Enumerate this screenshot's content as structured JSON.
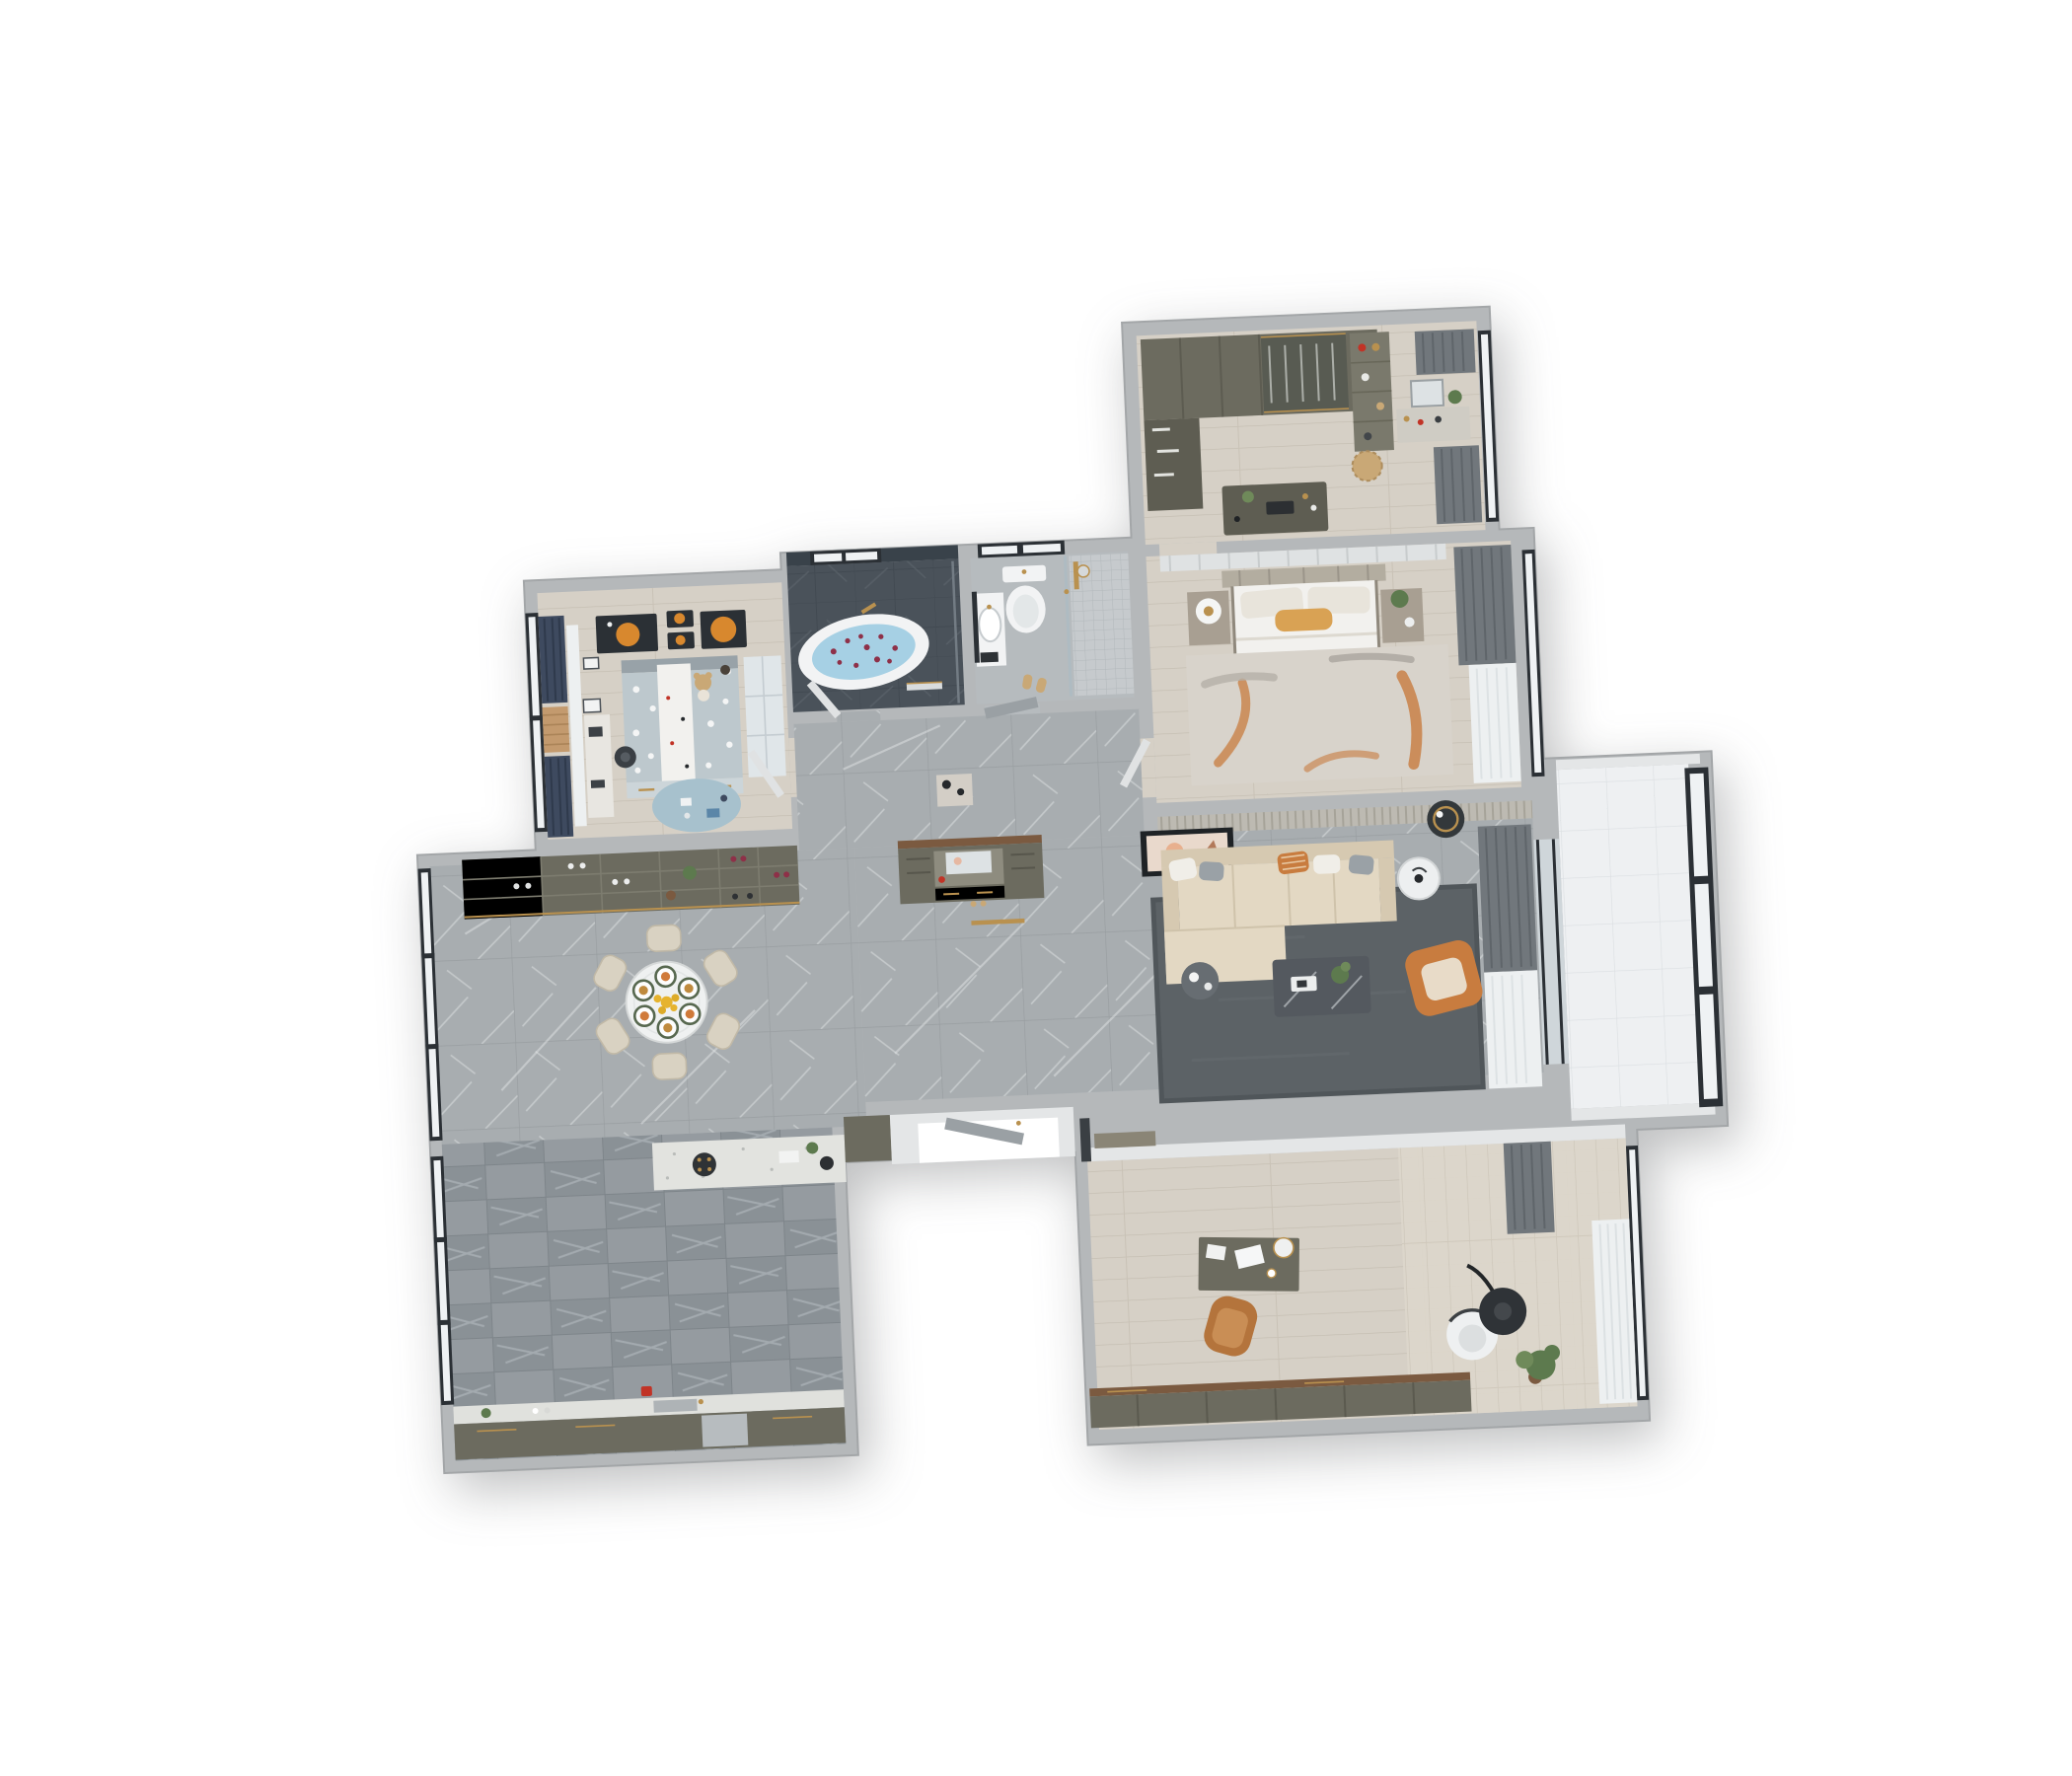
{
  "scene": {
    "type": "3d-rendered-apartment-floor-plan",
    "view": "top-down dollhouse cutaway",
    "background": "#ffffff",
    "visible_text": "none"
  },
  "palette": {
    "wall": "#b5b8ba",
    "wallEdge": "#a3a6a8",
    "wallWhite": "#e4e6e7",
    "floorMarble": "#a8adb0",
    "floorWood": "#d6d0c6",
    "floorWoodStudy": "#dad4c9",
    "floorKitchen": "#93999d",
    "floorBalcony": "#eef0f2",
    "floorBath": "#b6bbbe",
    "floorEntry": "#c9ccce",
    "slate": "#4a525a",
    "slateWall": "#39424a",
    "mosaic": "#c6cacd",
    "olive": "#6c6b5f",
    "oliveDark": "#5e5d52",
    "brownTop": "#7b5a40",
    "sofa": "#e3d8c3",
    "sofaShade": "#d6c9b1",
    "cushionWhite": "#f0eee8",
    "cushionGray": "#9aa1a6",
    "orange": "#c87c3f",
    "orangePillow": "#d9a254",
    "rugLiving": "#5c6266",
    "rugBedroom": "#d8d3cb",
    "rugKids": "#a7c1cd",
    "navy": "#3e4a5f",
    "curtain": "#71777c",
    "sheer": "#edf0f1",
    "frame": "#2b3035",
    "glass": "#eff2f4",
    "gold": "#b9914f",
    "fixture": "#f2f3f4",
    "water": "#a6d0e4",
    "petal": "#8e3048",
    "green": "#5d7a4e",
    "greenLight": "#6f8a5a",
    "tan": "#c9a876",
    "chairTan": "#b4743c",
    "black": "#26292c",
    "bedding": "#f2f1ee",
    "blanket": "#ccc5bb",
    "kidsBed": "#bdc8cd",
    "headboard": "#b3ada0",
    "nightstand": "#a89f92",
    "tableDark": "#54595f",
    "artPeach": "#e9d9cc",
    "artOrange": "#d8882e",
    "red": "#c13326",
    "doorGray": "#9aa0a4",
    "doorLight": "#e0e2e3",
    "chairDining": "#d9d2c2",
    "grille": "#bdbab2",
    "cabinetNiche": "#8e8c7f",
    "mirror": "#dde2e4"
  },
  "rooms": [
    {
      "id": "walk-in-closet",
      "label": "Walk-in closet / dressing room",
      "floor": "light wood",
      "furniture": [
        "wardrobe-hanging-clothes",
        "glass-front-wardrobe",
        "shelf-unit-with-bags",
        "vanity-with-mirror",
        "plants",
        "rattan-basket",
        "accessory-island",
        "gray-curtains",
        "window"
      ]
    },
    {
      "id": "master-bedroom",
      "label": "Master bedroom",
      "floor": "light wood",
      "furniture": [
        "double-bed",
        "slatted-headboard",
        "pillows",
        "orange-lumbar-pillow",
        "white-duvet",
        "foot-blanket",
        "nightstand-left",
        "round-table-lamp",
        "nightstand-right",
        "plant",
        "rug-orange-accents",
        "layered-curtains",
        "window",
        "door"
      ]
    },
    {
      "id": "bathroom-tub",
      "label": "Bathroom with freestanding tub",
      "floor": "dark slate",
      "furniture": [
        "oval-bathtub",
        "water-with-rose-petals",
        "gold-faucet",
        "towel-rail",
        "window",
        "door"
      ]
    },
    {
      "id": "bathroom-shower",
      "label": "Bathroom with shower",
      "floor": "light marble + mosaic",
      "furniture": [
        "wall-hung-toilet",
        "vanity-basin",
        "wall-mirror",
        "glass-shower-enclosure",
        "gold-shower-set",
        "slippers",
        "window",
        "door"
      ]
    },
    {
      "id": "kids-bedroom",
      "label": "Kids bedroom",
      "floor": "light wood",
      "furniture": [
        "single-bed-polka-dot-bedding",
        "white-blanket-runner",
        "teddy-bear",
        "toy-deer",
        "under-bed-drawers",
        "wardrobe",
        "study-desk",
        "desk-chair",
        "round-play-rug",
        "toys",
        "planet-artworks-x4",
        "navy-curtains",
        "sheer-curtain",
        "window",
        "door"
      ]
    },
    {
      "id": "dining-area",
      "label": "Dining area",
      "floor": "gray marble",
      "furniture": [
        "round-dining-table",
        "dining-chairs-x6",
        "place-settings-x6",
        "yellow-flower-centerpiece",
        "wine-display-cabinet",
        "glass-display-cabinet",
        "window-wall"
      ]
    },
    {
      "id": "kitchen",
      "label": "Kitchen",
      "floor": "dark patterned tile",
      "furniture": [
        "island-counter-with-hob",
        "plant-and-bowl",
        "base-cabinet-run",
        "countertop-with-sink",
        "dishwasher",
        "red-kettle",
        "tall-cabinet",
        "window-wall"
      ]
    },
    {
      "id": "living-room",
      "label": "Living room",
      "floor": "gray marble",
      "furniture": [
        "l-shaped-sectional-sofa",
        "throw-pillows",
        "striped-orange-pillow",
        "marble-coffee-table",
        "plant",
        "tray",
        "round-side-table-white",
        "round-side-table-dark",
        "orange-armchair",
        "dark-gray-rug",
        "wall-art",
        "black-ceiling-light",
        "curtains",
        "entry-shoe-cabinet-with-mirror-niche",
        "console-table",
        "gold-floor-strips",
        "ceiling-grille"
      ]
    },
    {
      "id": "balcony",
      "label": "Balcony",
      "floor": "white tile",
      "furniture": [
        "panoramic-window",
        "sliding-glass-door"
      ]
    },
    {
      "id": "study",
      "label": "Study / office",
      "floor": "wood planks",
      "furniture": [
        "writing-desk",
        "laptop",
        "desk-lamp",
        "coffee-cup",
        "papers",
        "tan-desk-chair",
        "credenza",
        "white-lounge-chair",
        "black-arc-floor-lamp",
        "potted-plant",
        "gray-curtain-panel",
        "sheer-curtains",
        "olive-door",
        "window"
      ]
    },
    {
      "id": "entry-vestibule",
      "label": "Entry vestibule",
      "floor": "light tile",
      "furniture": [
        "entry-door-leaf",
        "white-walls",
        "door-opening"
      ]
    },
    {
      "id": "corridor",
      "label": "Corridor",
      "floor": "gray marble",
      "furniture": [
        "console-with-vases",
        "door-to-tub-bathroom",
        "door-to-shower-bathroom",
        "door-to-bedroom",
        "door-to-kids-room"
      ]
    }
  ]
}
